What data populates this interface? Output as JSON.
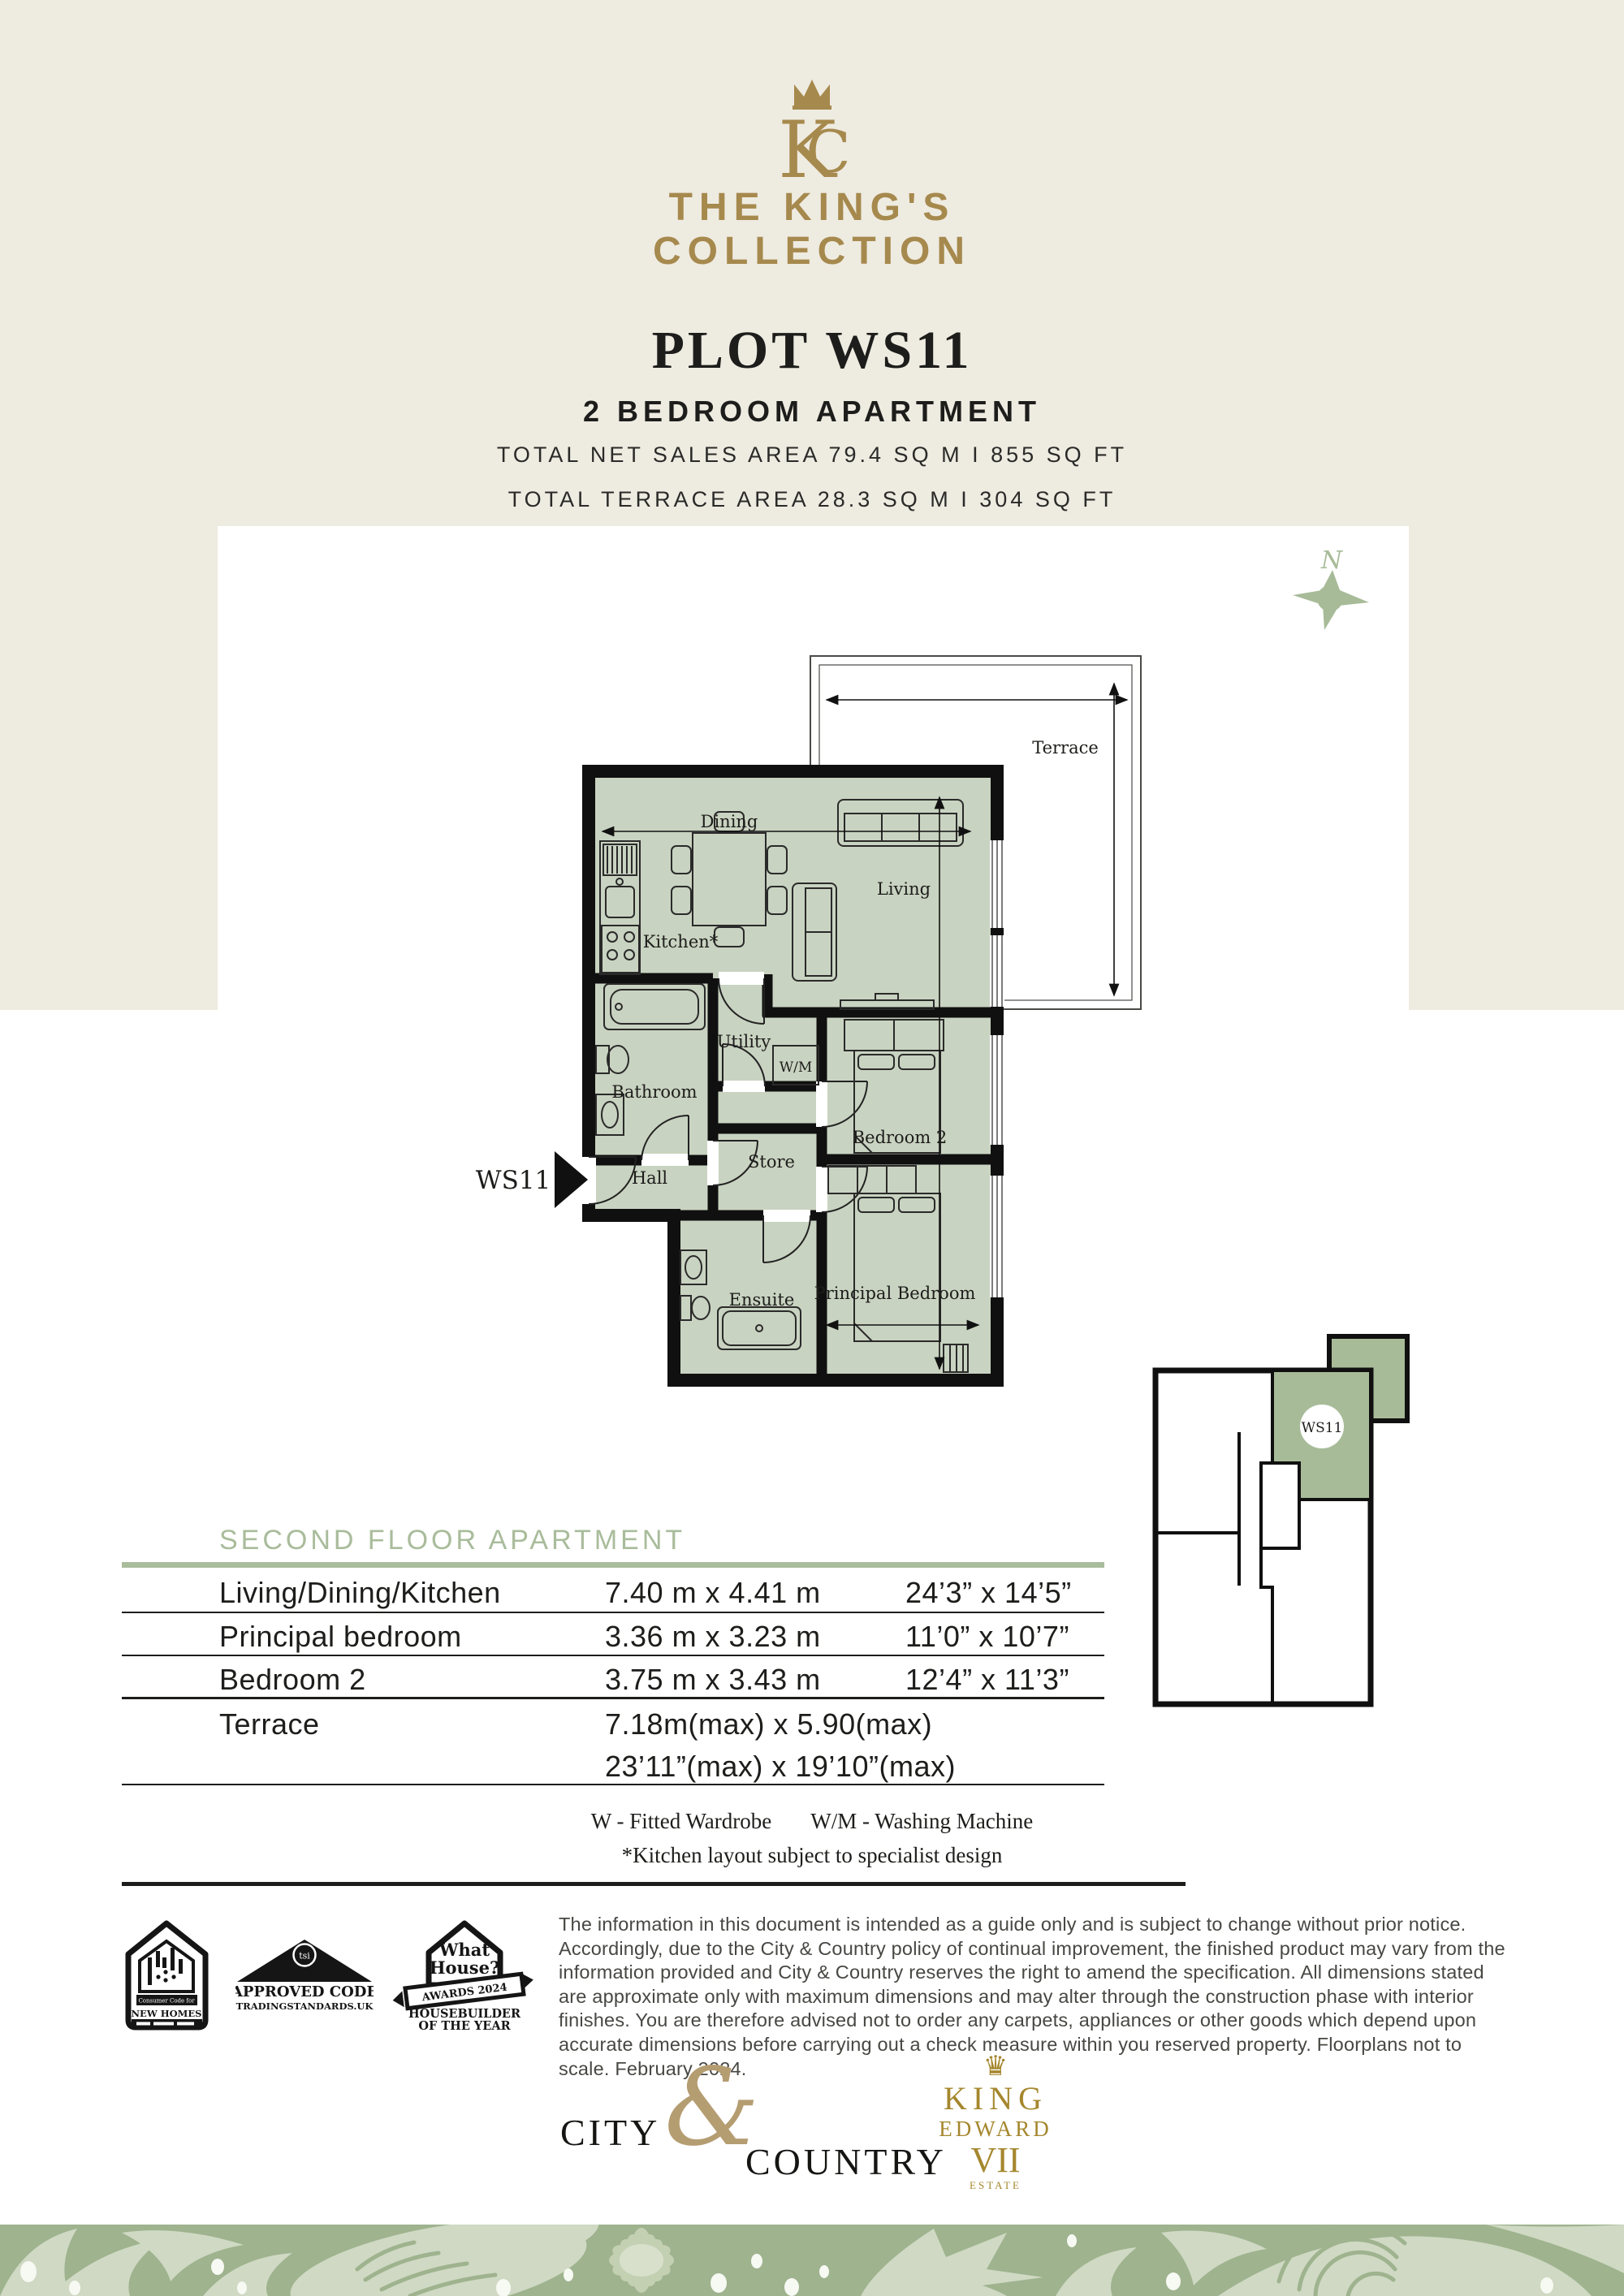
{
  "brand": {
    "monogram_letters": "KC",
    "name_line1": "THE KING'S",
    "name_line2": "COLLECTION"
  },
  "header": {
    "plot_title": "PLOT WS11",
    "subtitle": "2 BEDROOM APARTMENT",
    "area_line1": "TOTAL NET SALES AREA 79.4 SQ M  I  855 SQ FT",
    "area_line2": "TOTAL TERRACE AREA 28.3 SQ M  I  304 SQ FT"
  },
  "compass": {
    "label": "N"
  },
  "floorplan": {
    "unit_label": "WS11",
    "rooms": [
      {
        "label": "Dining"
      },
      {
        "label": "Living"
      },
      {
        "label": "Kitchen*"
      },
      {
        "label": "Utility"
      },
      {
        "label": "W/M"
      },
      {
        "label": "Bathroom"
      },
      {
        "label": "Hall"
      },
      {
        "label": "Store"
      },
      {
        "label": "Bedroom 2"
      },
      {
        "label": "Ensuite"
      },
      {
        "label": "Principal Bedroom"
      },
      {
        "label": "Terrace"
      }
    ]
  },
  "locator": {
    "unit_label": "WS11"
  },
  "table": {
    "heading": "SECOND FLOOR APARTMENT",
    "rows": [
      {
        "name": "Living/Dining/Kitchen",
        "metric": "7.40 m x 4.41 m",
        "imperial": "24’3” x 14’5”"
      },
      {
        "name": "Principal bedroom",
        "metric": "3.36 m x 3.23 m",
        "imperial": "11’0” x 10’7”"
      },
      {
        "name": "Bedroom 2",
        "metric": "3.75 m x 3.43 m",
        "imperial": "12’4” x 11’3”"
      }
    ],
    "terrace_row": {
      "name": "Terrace",
      "metric_line1": "7.18m(max) x 5.90(max)",
      "metric_line2": "23’11”(max) x 19’10”(max)"
    },
    "notes": {
      "wardrobe": "W - Fitted Wardrobe",
      "washing_machine": "W/M - Washing Machine",
      "kitchen": "*Kitchen layout subject to specialist design"
    }
  },
  "badges": {
    "new_homes": {
      "small": "Consumer Code for",
      "main": "NEW HOMES"
    },
    "tsi": {
      "circle": "tsi",
      "line1": "APPROVED CODE",
      "line2": "TRADINGSTANDARDS.UK"
    },
    "what_house": {
      "line1": "What",
      "line2": "House?",
      "ribbon": "AWARDS 2024",
      "line3": "HOUSEBUILDER",
      "line4": "OF THE YEAR"
    }
  },
  "disclaimer": "The information in this document is intended as a guide only and is subject to change without prior notice. Accordingly, due to the City & Country policy of continual improvement, the finished product may vary from the information provided and City & Country reserves the right to amend the specification. All dimensions stated are approximate only with maximum dimensions and may alter through the construction phase with interior finishes. You are therefore advised not to order any carpets, appliances or other goods which depend upon accurate dimensions before carrying out a check measure within you reserved property. Floorplans not to scale. February 2024.",
  "footer": {
    "city": "CITY",
    "ampersand": "&",
    "country": "COUNTRY",
    "king_edward": {
      "crown": "♛",
      "line1": "KING",
      "line2": "EDWARD",
      "line3": "VII",
      "line4": "ESTATE"
    }
  },
  "colors": {
    "cream": "#eeebe1",
    "gold": "#a6894d",
    "sage_accent": "#a9bc9b",
    "room_fill": "#c9d3c1",
    "plan_green": "#a7bb98",
    "floral_bg": "#9eb38e",
    "floral_light": "#cfd9c3",
    "ink": "#1d1d1b"
  }
}
